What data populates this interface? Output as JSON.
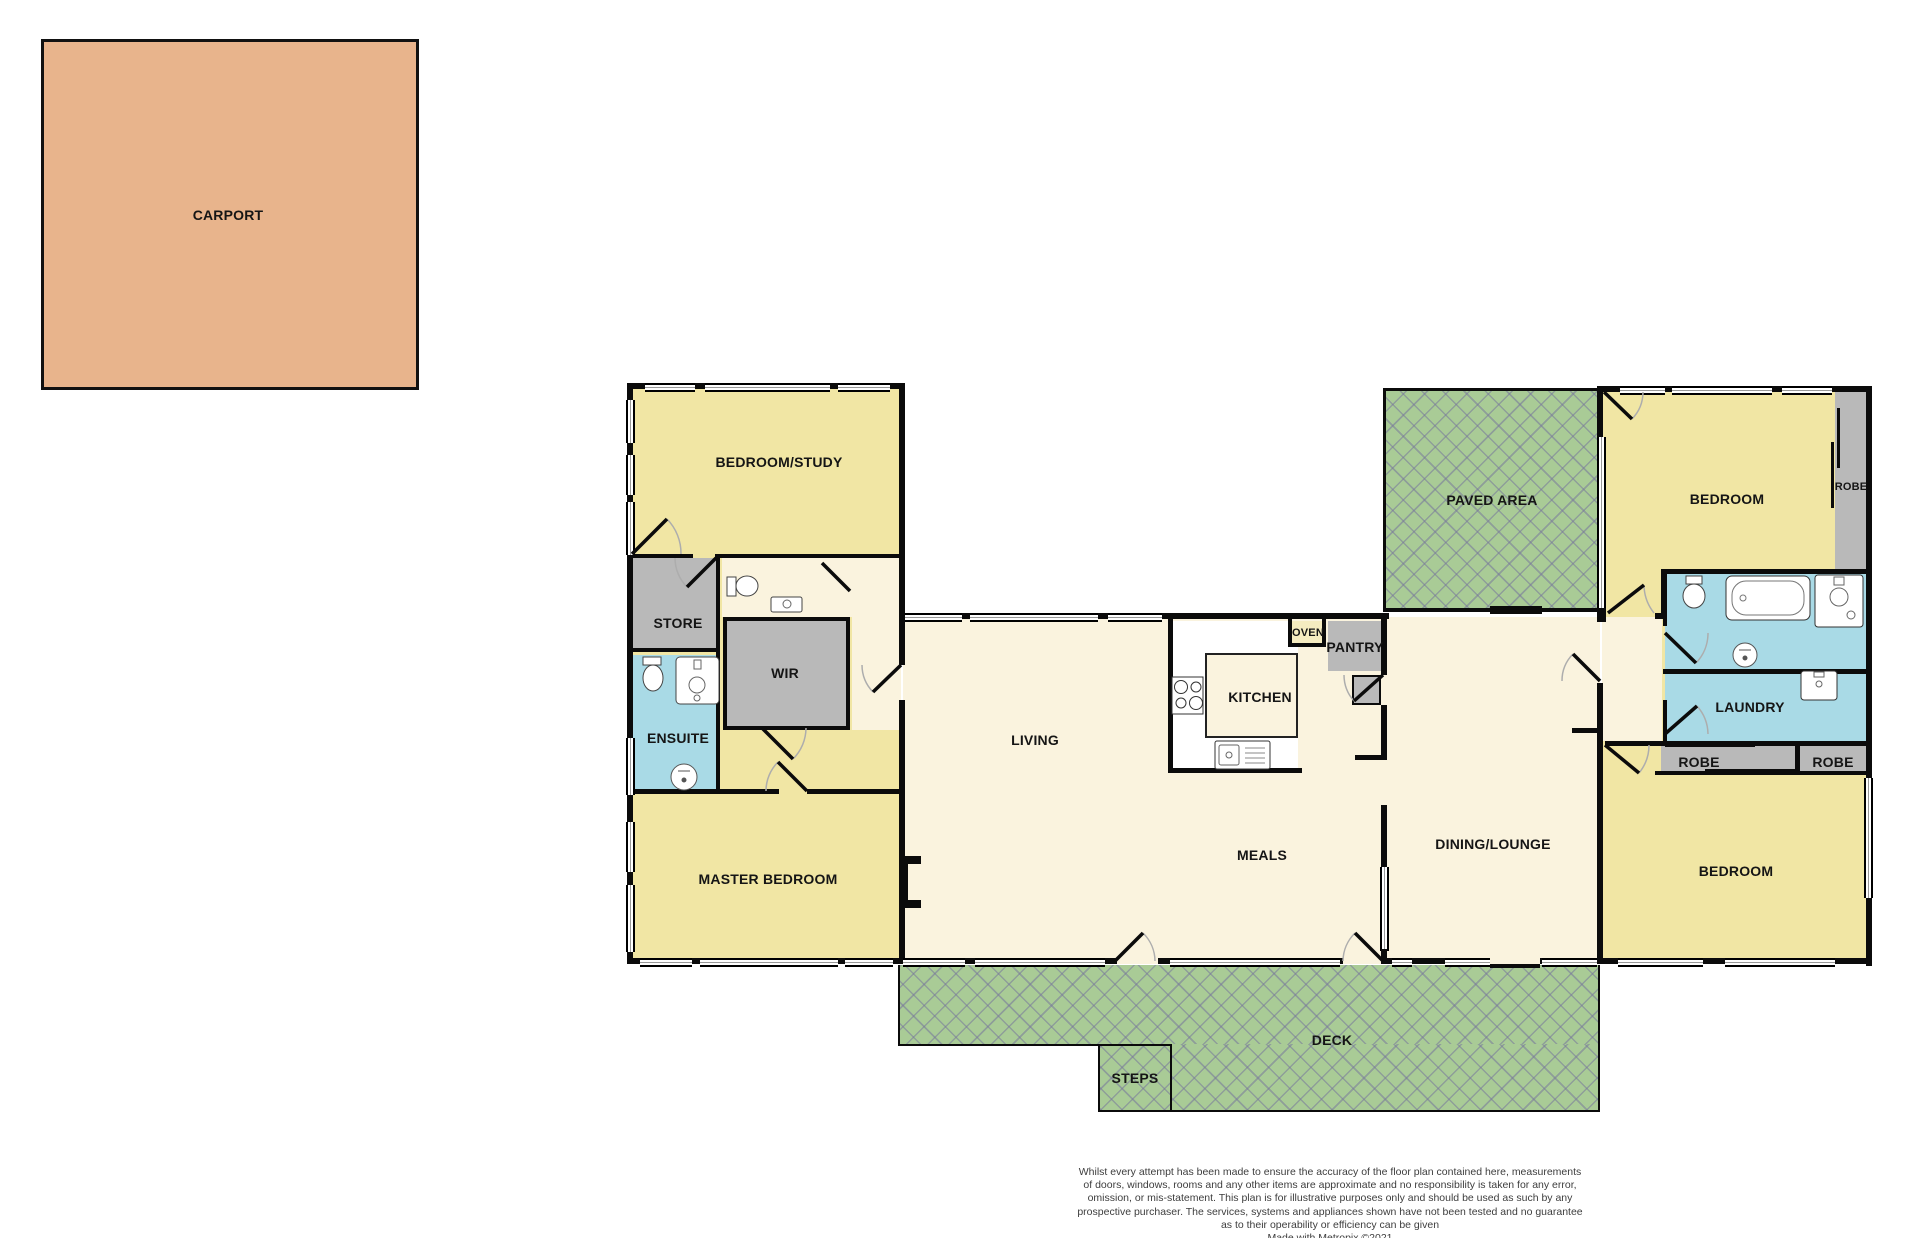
{
  "floorplan": {
    "rooms": {
      "carport": "CARPORT",
      "bedroom_study": "BEDROOM/STUDY",
      "store": "STORE",
      "wir": "WIR",
      "ensuite": "ENSUITE",
      "master_bedroom": "MASTER BEDROOM",
      "living": "LIVING",
      "kitchen": "KITCHEN",
      "oven": "OVEN",
      "pantry": "PANTRY",
      "meals": "MEALS",
      "dining_lounge": "DINING/LOUNGE",
      "paved_area": "PAVED AREA",
      "bedroom_top": "BEDROOM",
      "robe_top": "ROBE",
      "laundry": "LAUNDRY",
      "robe_left": "ROBE",
      "robe_right": "ROBE",
      "bedroom_bottom": "BEDROOM",
      "deck": "DECK",
      "steps": "STEPS"
    },
    "colors": {
      "carport_fill": "#e8b48c",
      "bedroom_fill": "#f1e6a4",
      "living_fill": "#faf3de",
      "wet_area_fill": "#a9dae6",
      "storage_fill": "#b9b9b9",
      "outdoor_fill": "#a9cb96",
      "wall": "#0b0b0b"
    },
    "disclaimer": "Whilst every attempt has been made to ensure the accuracy of the floor plan contained here, measurements\nof doors, windows, rooms and any other items are approximate and no responsibility is taken for any error,\nomission, or mis-statement. This plan is for illustrative purposes only and should be used as such by any\nprospective purchaser. The services, systems and appliances shown have not been tested and no guarantee\nas to their operability or efficiency can be given\nMade with Metropix ©2021"
  }
}
